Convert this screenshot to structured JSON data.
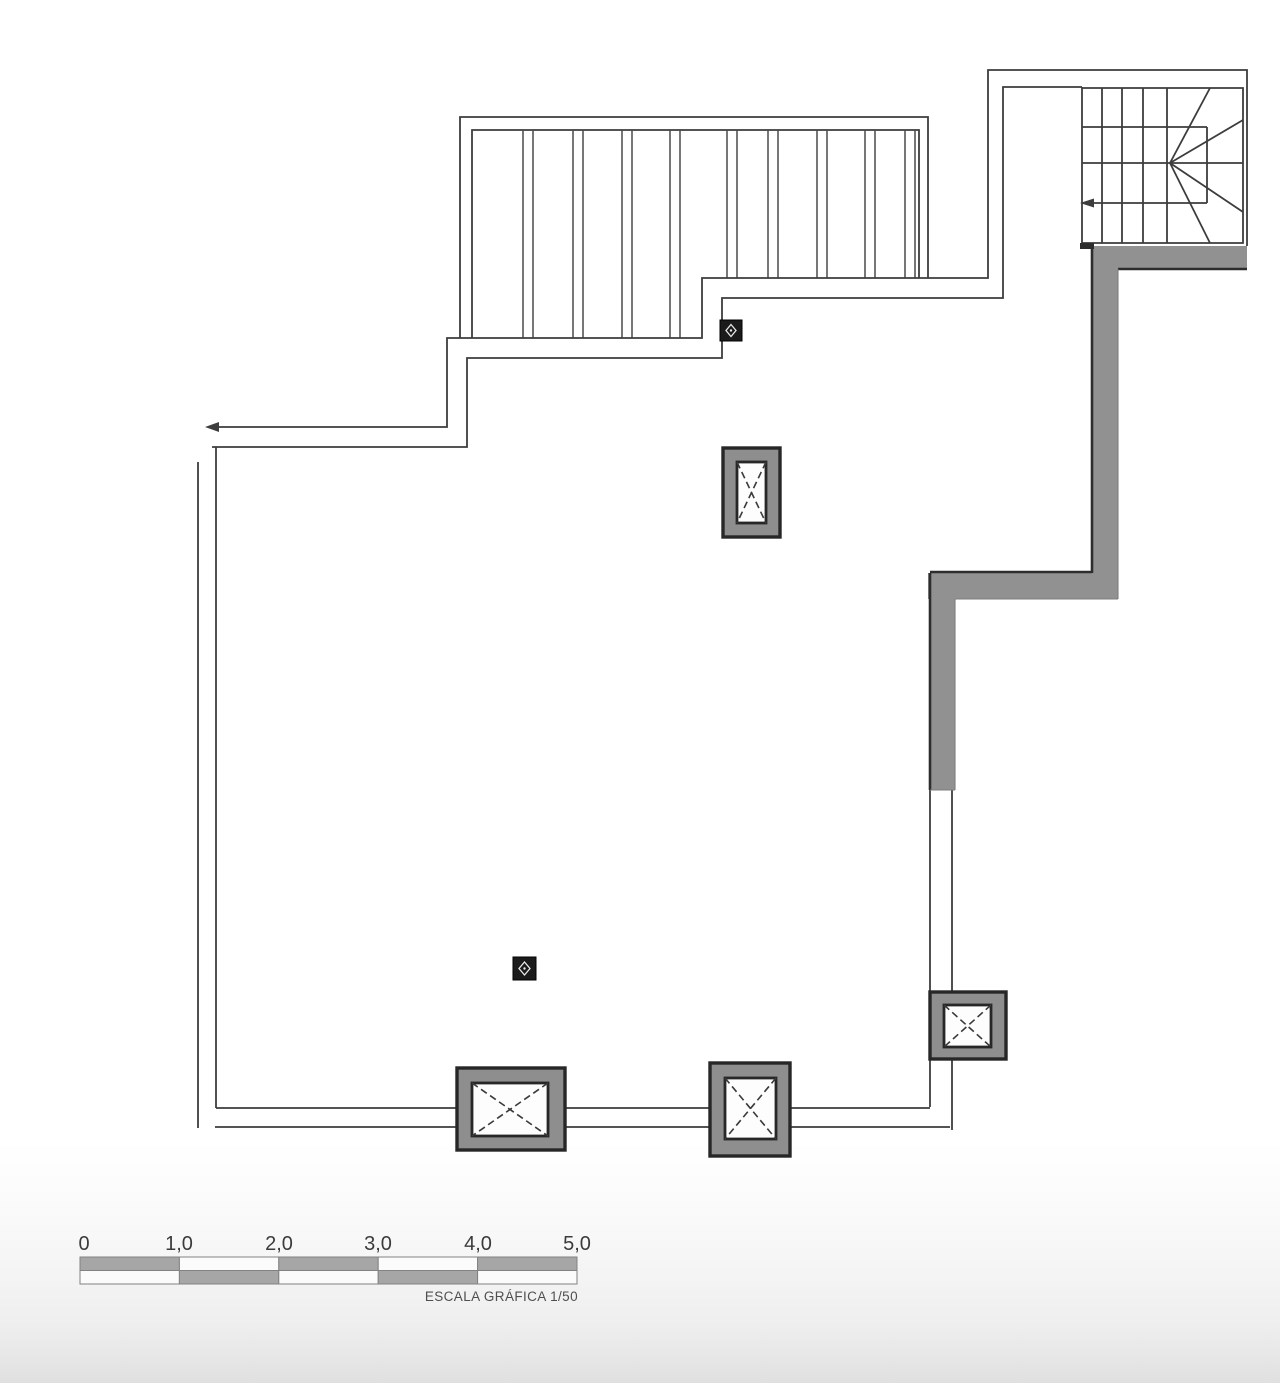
{
  "scale_bar": {
    "labels": [
      "0",
      "1,0",
      "2,0",
      "3,0",
      "4,0",
      "5,0"
    ],
    "caption": "ESCALA GRÁFICA 1/50"
  },
  "colors": {
    "line": "#3d3d3d",
    "edge_dark": "#2d2d2d",
    "wall_fill": "#919191",
    "column_fill": "#8e8e8e",
    "fixture_black": "#1b1b1b",
    "bar_gray": "#a6a6a6",
    "bar_white": "#fbfbfb"
  }
}
